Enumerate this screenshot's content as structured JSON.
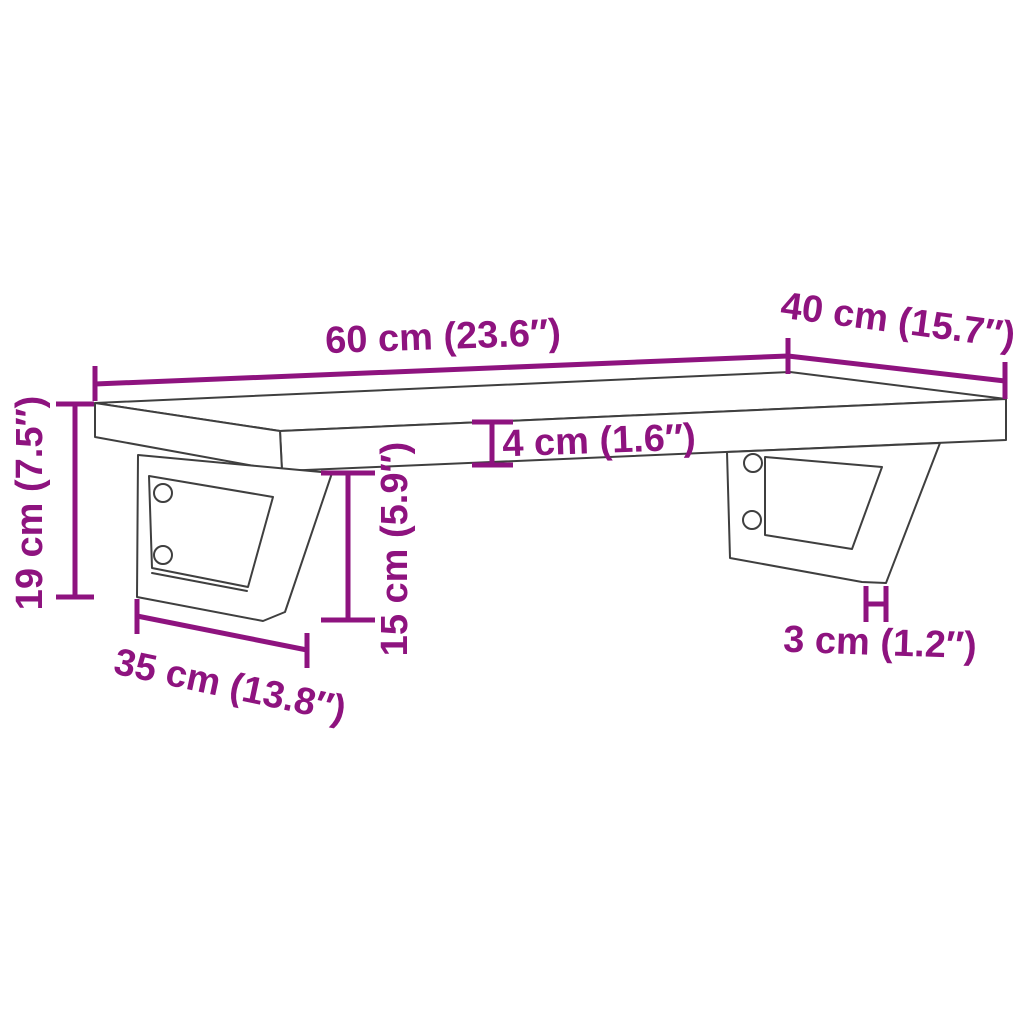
{
  "diagram": {
    "kind": "product-dimension-diagram",
    "subject": "wall-mounted shelf board on two triangular steel brackets, perspective line drawing",
    "background_color": "#ffffff",
    "accent_color": "#8e137f",
    "line_color": "#3f3f3f",
    "dimensions": [
      {
        "id": "board-width",
        "label": "60 cm (23.6″)",
        "value_cm": 60,
        "value_in": 23.6
      },
      {
        "id": "board-depth",
        "label": "40 cm (15.7″)",
        "value_cm": 40,
        "value_in": 15.7
      },
      {
        "id": "board-thickness",
        "label": "4 cm (1.6″)",
        "value_cm": 4,
        "value_in": 1.6
      },
      {
        "id": "total-height",
        "label": "19 cm (7.5″)",
        "value_cm": 19,
        "value_in": 7.5
      },
      {
        "id": "bracket-drop",
        "label": "15 cm (5.9″)",
        "value_cm": 15,
        "value_in": 5.9
      },
      {
        "id": "bracket-depth",
        "label": "35 cm (13.8″)",
        "value_cm": 35,
        "value_in": 13.8
      },
      {
        "id": "foot-width",
        "label": "3 cm (1.2″)",
        "value_cm": 3,
        "value_in": 1.2
      }
    ]
  }
}
